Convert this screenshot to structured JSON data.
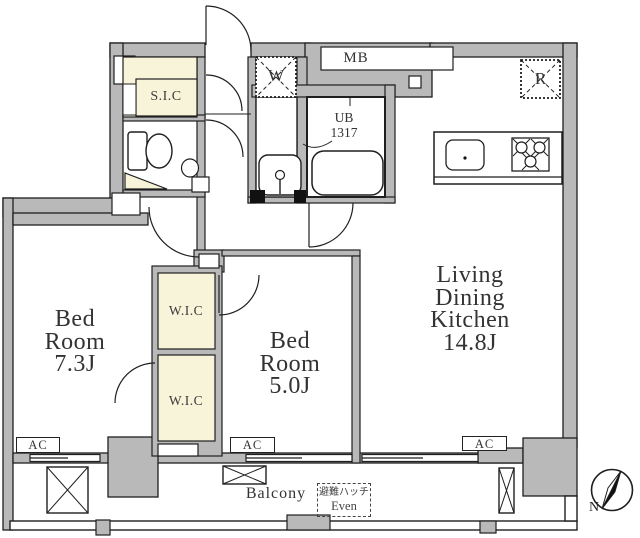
{
  "floorplan": {
    "rooms": {
      "ldk": {
        "name_lines": [
          "Living",
          "Dining",
          "Kitchen"
        ],
        "size": "14.8J"
      },
      "bedroom1": {
        "name_lines": [
          "Bed",
          "Room"
        ],
        "size": "7.3J"
      },
      "bedroom2": {
        "name_lines": [
          "Bed",
          "Room"
        ],
        "size": "5.0J"
      },
      "wic_upper": {
        "label": "W.I.C"
      },
      "wic_lower": {
        "label": "W.I.C"
      },
      "sic": {
        "label": "S.I.C"
      },
      "balcony": {
        "label": "Balcony"
      }
    },
    "labels": {
      "meter_box": "MB",
      "washing_machine": "W",
      "refrigerator": "R",
      "unit_bath": {
        "line1": "UB",
        "line2": "1317"
      },
      "ac_units": [
        "AC",
        "AC",
        "AC"
      ],
      "evacuation_hatch": {
        "line1": "避難ハッチ",
        "line2": "Even"
      },
      "compass_north": "N"
    },
    "colors": {
      "wall_fill": "#b9b9b9",
      "closet_fill": "#f8f4da",
      "outline": "#1f1f1f",
      "background": "#ffffff"
    }
  }
}
